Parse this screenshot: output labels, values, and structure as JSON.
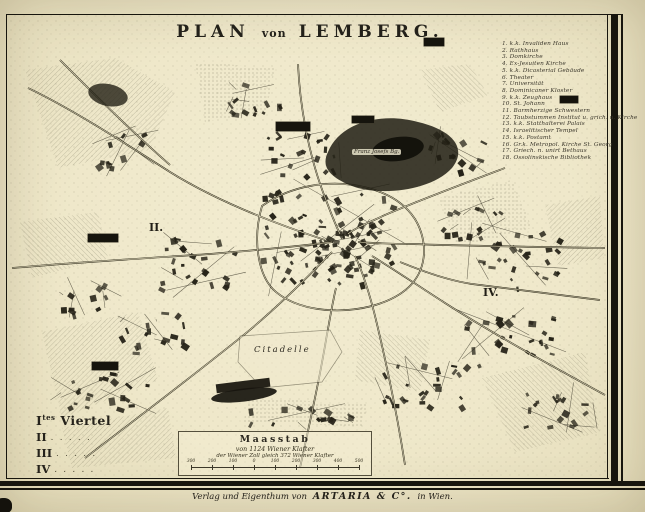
{
  "title": {
    "part1": "PLAN",
    "part2": "von",
    "part3": "LEMBERG."
  },
  "legend": {
    "items": [
      "1. k.k. Invaliden Haus",
      "2. Rathhaus",
      "3. Domkirche",
      "4. Ex-Jesuiten Kirche",
      "5. k.k. Dicasterial Gebäude",
      "6. Theater",
      "7. Universität",
      "8. Dominicaner Kloster",
      "9. k.k. Zeughaus",
      "10. St. Johann",
      "11. Barmherzige Schwestern",
      "12. Taubstummen Institut u. grich. u. Kirche",
      "13. k.k. Statthalterei Palais",
      "14. Israelitischer Tempel",
      "15. k.k. Postamt",
      "16. Gr.k. Metropol. Kirche St. Georg",
      "17. Griech. n. unirt Bethaus",
      "18. Ossolinskische Bibliothek"
    ]
  },
  "quarters": {
    "first": {
      "numeral": "I",
      "sup": "tes",
      "label": "Viertel"
    },
    "rows": [
      {
        "numeral": "II",
        "leader": ". . . . ."
      },
      {
        "numeral": "III",
        "leader": ". . . . ."
      },
      {
        "numeral": "IV",
        "leader": ". . . . ."
      }
    ]
  },
  "scalebox": {
    "title": "Maasstab",
    "subtitle": "von 1124 Wiener Klafter",
    "note": "der Wiener Zoll gleich 372 Wiener Klafter",
    "ticks": [
      "300",
      "200",
      "100",
      "0",
      "100",
      "200",
      "300",
      "400",
      "500"
    ]
  },
  "map_labels": {
    "citadelle": "Citadelle",
    "franz_josefs_berg": "Franz Josefs Bg.",
    "district_ii": "II.",
    "district_iv": "IV."
  },
  "publisher": {
    "prefix": "Verlag und Eigenthum von",
    "name": "ARTARIA & C°.",
    "suffix": "in Wien."
  },
  "colors": {
    "paper": "#efe8cc",
    "ink": "#2b2820",
    "frame": "#17150d"
  }
}
